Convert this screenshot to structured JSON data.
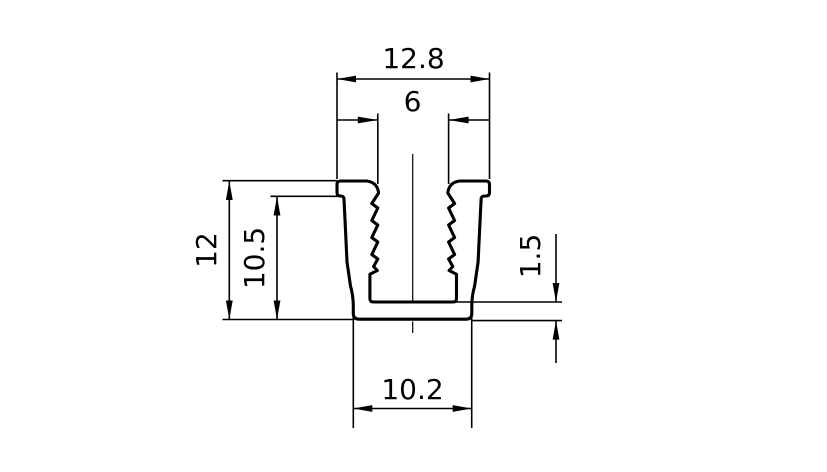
{
  "drawing": {
    "kind": "technical-cross-section",
    "subject": "serrated U-channel extrusion profile"
  },
  "dimensions": {
    "outer_width": "12.8",
    "slot_width": "6",
    "overall_height": "12",
    "inner_height": "10.5",
    "base_thickness": "1.5",
    "base_width": "10.2"
  },
  "colors": {
    "line": "#000000",
    "text": "#000000",
    "background": "#ffffff",
    "profile_fill": "#ffffff"
  }
}
